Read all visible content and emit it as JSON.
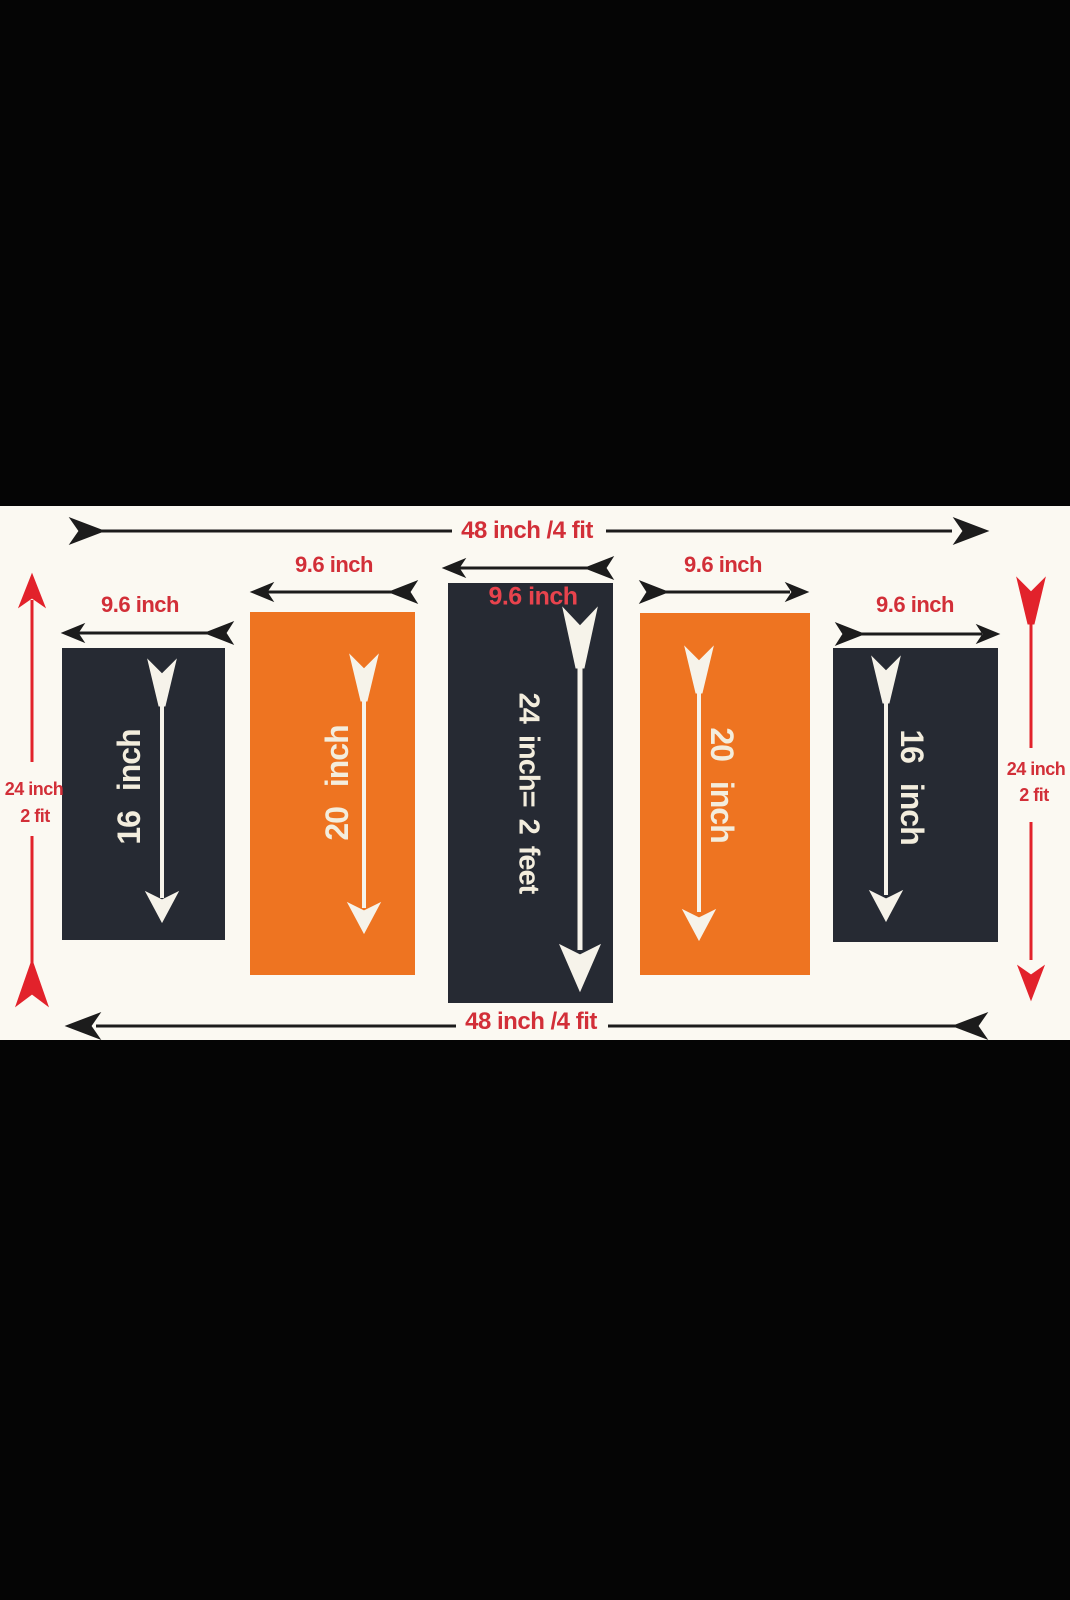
{
  "title": "Five panel wall art measurement diagram",
  "colors": {
    "background": "#050505",
    "canvas": "#fbf9f2",
    "dark_panel": "#262a33",
    "orange_panel": "#ee7421",
    "red_text": "#d22f38",
    "red_arrow": "#e2222b",
    "black_arrow": "#1c1c1c",
    "panel_text": "#f3eddd"
  },
  "top_dimension": {
    "label": "48 inch /4 fit"
  },
  "bottom_dimension": {
    "label": "48 inch /4 fit"
  },
  "left_dimension": {
    "line1": "24 inch",
    "line2": "2 fit"
  },
  "right_dimension": {
    "line1": "24 inch",
    "line2": "2 fit"
  },
  "panels": [
    {
      "position": "far-left",
      "color": "dark",
      "width_label": "9.6 inch",
      "height_label": "16 inch"
    },
    {
      "position": "left",
      "color": "orange",
      "width_label": "9.6 inch",
      "height_label": "20 inch"
    },
    {
      "position": "center",
      "color": "dark",
      "width_label": "9.6 inch",
      "height_label": "24 inch= 2 feet"
    },
    {
      "position": "right",
      "color": "orange",
      "width_label": "9.6 inch",
      "height_label": "20 inch"
    },
    {
      "position": "far-right",
      "color": "dark",
      "width_label": "9.6 inch",
      "height_label": "16 inch"
    }
  ]
}
